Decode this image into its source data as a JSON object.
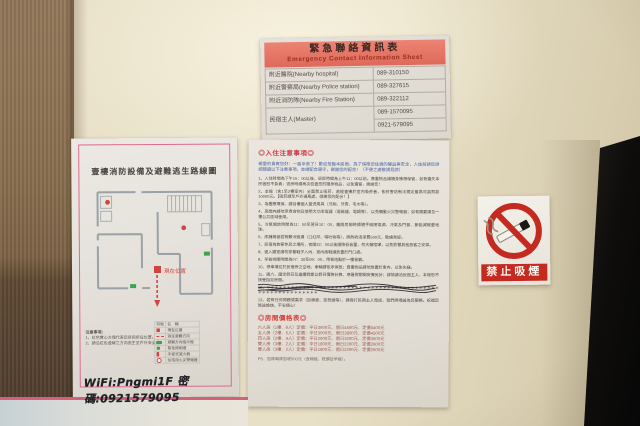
{
  "emergency_sheet": {
    "title_zh": "緊急聯絡資訊表",
    "title_en": "Emergency Contact Information Sheet",
    "rows": [
      {
        "label": "附近醫院(Nearby hospital)",
        "phone": "089-310150"
      },
      {
        "label": "附近警察局(Nearby Police station)",
        "phone": "089-327615"
      },
      {
        "label": "附近消防隊(Nearby Fire Station)",
        "phone": "089-322112"
      },
      {
        "label": "民宿主人(Master)",
        "phone": "089-1570095",
        "phone2": "0921-579095"
      }
    ]
  },
  "floor_plan": {
    "title": "壹樓消防設備及避難逃生路線圖",
    "notes_title": "注意事項：",
    "notes": [
      "1、紅色實心方塊代表您目前所在位置。",
      "2、請沿紅色虛線之方向逃生至戶外安全處。"
    ],
    "legend_header": {
      "symbol": "符號",
      "name": "名　稱"
    },
    "legend": [
      {
        "name": "現在位置"
      },
      {
        "name": "逃生避難方向"
      },
      {
        "name": "避難方向指示燈"
      },
      {
        "name": "緊急照明燈"
      },
      {
        "name": "手提式滅火器"
      },
      {
        "name": "住宅用火災警報器"
      }
    ],
    "position_label": "現在位置"
  },
  "wifi_note": "WiFi:Pngmi1F 密碼:0921579095",
  "notice": {
    "title": "◎入住注意事項◎",
    "intro": "親愛的貴賓您好：一路辛苦了！歡迎蒞臨本民宿，為了保障您住宿的權益與安全，入住前請您詳細閱讀以下注意事項，並請配合遵守，謝謝您的配合！（不便之處敬請見諒）",
    "items": [
      "1、入住時間為下午15：00以後，退房時間為上午11：00以前。貴重物品請隨身攜帶保管，如有遺失本民宿恕不負責；退房時請再次檢查您的隨身物品，以免遺留，謝謝您！",
      "2、本館（含1至2樓室內）全面禁止吸菸，若經查獲於室內吸菸者，依菸害防制法規定最高可處罰款10000元。【吸菸請至戶外通風處，感謝您的配合！】",
      "3、為響應環保，請自備個人盥洗用具（牙刷、牙膏、毛巾等）。",
      "4、房間內請勿烹煮食物及使用大功率電器（電磁爐、電鍋等），以免觸動火災警報器；如有需要請至一樓公共區域使用。",
      "5、冷氣開放時間為11：00至翌日10：00，離開房間時請隨手關閉電源、冷氣及門窗，節能減碳愛地球。",
      "6、床鋪棉被若有髒污毀損（口紅印、嘔吐物等），將酌收清潔費500元，敬請見諒。",
      "7、民宿為旅客休息之場所，夜間22：00以後請降低音量，勿大聲喧嘩，以免影響其他旅客之安寧。",
      "8、進入寢室請勿穿著鞋子入內，室內拖鞋請放置於門口處。",
      "9、早餐供應時間為07：30至09：00，用餐地點於一樓餐廳。",
      "10、停車場位於民宿旁之空地，車輛請依序停放；貴重物品請勿放置於車內，以免失竊。",
      "11、週六、國定假日及連續假期以假日價格計算，寒暑假期間房價另計；詳情請洽民宿主人，本館恕不接受指定房間。",
      "12、＊＊＊＊＊＊＊＊＊＊＊＊＊＊＊＊＊＊＊＊＊＊＊＊＊＊＊＊＊＊＊＊＊＊＊＊＊＊＊＊＊＊＊＊＊＊＊＊＊＊＊＊＊＊＊＊＊＊",
      "13、若有任何問題或需求（加棉被、加枕頭等），請撥打民宿主人電話，我們將竭誠為您服務。祝福您旅途愉快、平安順心！"
    ],
    "price_title": "◎房間價格表◎",
    "price_lines": [
      "六人房（1樓．6人）定價：平日3600元．假日4500元．定價5400元",
      "五人房（2樓．5人）定價：平日3000元．假日3800元．定價4500元",
      "四人房（2樓．4人）定價：平日2600元．假日3200元．定價3600元",
      "雙人房（3樓．2人）定價：平日1800元．假日2200元．定價2600元",
      "雙人房（3樓．2人）定價：平日1800元．假日2200元．定價2600元"
    ],
    "ps_line": "PS．加床每床加收500元（含棉被、枕頭及早餐）。"
  },
  "no_smoking_sign": {
    "label": "禁止吸煙"
  },
  "colors": {
    "wall": "#e7dfc6",
    "header_salmon": "#e8816e",
    "accent_red": "#c42a20",
    "note_blue": "#4a67a8",
    "price_red": "#9a5a50",
    "border_pink": "#dd6b8d"
  }
}
